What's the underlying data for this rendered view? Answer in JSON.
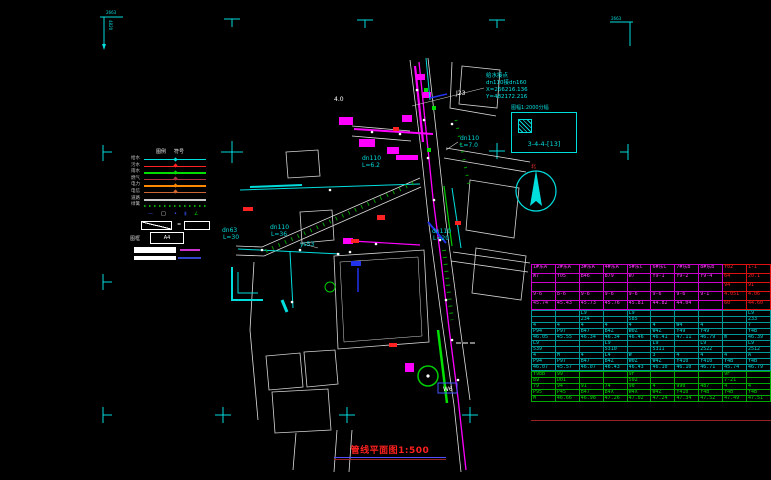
{
  "colors": {
    "accent_cyan": "#00dddd",
    "pipe_magenta": "#ff00ff",
    "road_white": "#e0e0e0",
    "veg_green": "#00cc00",
    "alert_red": "#ff2222",
    "aux_blue": "#2233ee"
  },
  "sheet": {
    "corner_tl_top": "2663",
    "corner_tl_side": "4820",
    "corner_tr": "2663"
  },
  "title": {
    "text": "管线平面图1:500"
  },
  "index_box": {
    "caption": "图幅1:2000分幅",
    "cell": "3-4-4-[13]"
  },
  "north": {
    "label": "北"
  },
  "note": {
    "lines": [
      "给水接点",
      "dn110接dn160",
      "X=266216.136",
      "Y=482172.216"
    ]
  },
  "map_labels": [
    {
      "text": "4.0",
      "x": 334,
      "y": 101,
      "color": "#ffffff"
    },
    {
      "text": "J23",
      "x": 456,
      "y": 95,
      "color": "#ffffff"
    },
    {
      "text": "dn110",
      "x": 460,
      "y": 140,
      "color": "#00dddd"
    },
    {
      "text": "L=7.0",
      "x": 460,
      "y": 147,
      "color": "#00dddd"
    },
    {
      "text": "dn110",
      "x": 362,
      "y": 160,
      "color": "#00dddd"
    },
    {
      "text": "L=6.2",
      "x": 362,
      "y": 167,
      "color": "#00dddd"
    },
    {
      "text": "dn110",
      "x": 270,
      "y": 229,
      "color": "#00dddd"
    },
    {
      "text": "L=36",
      "x": 271,
      "y": 236,
      "color": "#00dddd"
    },
    {
      "text": "dn110",
      "x": 432,
      "y": 233,
      "color": "#00dddd"
    },
    {
      "text": "L=20",
      "x": 433,
      "y": 240,
      "color": "#00dddd"
    },
    {
      "text": "dn63",
      "x": 222,
      "y": 232,
      "color": "#00dddd"
    },
    {
      "text": "L=30",
      "x": 223,
      "y": 239,
      "color": "#00dddd"
    },
    {
      "text": "ys53",
      "x": 300,
      "y": 246,
      "color": "#00dddd"
    },
    {
      "text": "W6",
      "x": 443,
      "y": 391,
      "color": "#ffffff"
    }
  ],
  "legend": {
    "headers": [
      "图例",
      "符号"
    ],
    "rows": [
      {
        "label": "给水",
        "color": "#00dddd",
        "sym": "#00dddd"
      },
      {
        "label": "污水",
        "color": "#ff2222",
        "sym": "#ff2222"
      },
      {
        "label": "雨水",
        "color": "#00dd00",
        "sym": "#00dd00"
      },
      {
        "label": "燃气",
        "color": "#aa3344",
        "sym": "#aa3344"
      },
      {
        "label": "电力",
        "color": "#ff8800",
        "sym": "#ff8800"
      },
      {
        "label": "电信",
        "color": "#cc6633",
        "sym": "#cc6633"
      },
      {
        "label": "道路",
        "color": "#c8c8c8",
        "h": "2.5px"
      },
      {
        "label": "绿篱",
        "style": "dotted"
      }
    ],
    "symbols": [
      {
        "g": "—",
        "c": "#4455ff",
        "x": "20px"
      },
      {
        "g": "□",
        "c": "#ffffff",
        "x": "33px"
      },
      {
        "g": "•",
        "c": "#4455ff",
        "x": "46px"
      },
      {
        "g": "▮",
        "c": "#223399",
        "x": "56px"
      },
      {
        "g": "∠",
        "c": "#00cc00",
        "x": "66px"
      }
    ],
    "slope_equals": "=",
    "frame_label": "图框",
    "frame_value": "A4"
  },
  "table": {
    "sections": [
      {
        "name": "existing-pipes",
        "rows": [
          [
            "1#东A",
            "2#东A",
            "3#东A",
            "4#东A",
            "5#东C",
            "6#东C",
            "7#东B",
            "8#东B",
            "Y02",
            "1-1"
          ],
          [
            "W7",
            "Y05",
            "B46",
            "B79",
            "W7",
            "Y9-1",
            "Y9-2",
            "Y9-4",
            "64",
            "20.1"
          ],
          [
            "",
            "",
            "",
            "",
            "",
            "",
            "",
            "",
            "94",
            "91"
          ],
          [
            "9-6",
            "8-6",
            "9-6",
            "9-6",
            "9-6",
            "9-6",
            "9-6",
            "9-1",
            "4.051",
            "4.06"
          ],
          [
            "45.74",
            "45.43",
            "45.73",
            "45.76",
            "45.81",
            "44.82",
            "44.04",
            "",
            "60",
            "44.60"
          ]
        ]
      },
      {
        "name": "design-pipes",
        "rows": [
          [
            "",
            "",
            "L9",
            "",
            "L9",
            "",
            "",
            "",
            "",
            "L9"
          ],
          [
            "",
            "",
            "234",
            "",
            "585",
            "",
            "",
            "",
            "",
            "233"
          ],
          [
            "4",
            "4",
            "4",
            "4",
            "4",
            "4",
            "W4",
            "4",
            "",
            "7"
          ],
          [
            "P94",
            "P97",
            "B47",
            "B4Z",
            "W0Z",
            "W4Z",
            "Y49",
            "Y49",
            "",
            "Y4B"
          ],
          [
            "46.05",
            "45.55",
            "46.34",
            "46.34",
            "46.46",
            "46.41",
            "47.11",
            "46.79",
            "m",
            "46.39"
          ],
          [
            "L9",
            "",
            "",
            "L9",
            "",
            "L9",
            "",
            "L9",
            "",
            "L9"
          ],
          [
            "539",
            "",
            "",
            "5310",
            "",
            "5311",
            "",
            "2522",
            "",
            "2512"
          ],
          [
            "4",
            "M",
            "4",
            "L4",
            "W",
            "3",
            "4",
            "4",
            "4",
            "A"
          ],
          [
            "P94",
            "P97",
            "B47",
            "B4Z",
            "W0Z",
            "W4Z",
            "Y410",
            "Y410",
            "Y4B",
            "Y4B"
          ],
          [
            "46.07",
            "45.57",
            "46.07",
            "46.43",
            "46.43",
            "46.10",
            "46.10",
            "46.71",
            "45.74",
            "46.79"
          ]
        ]
      },
      {
        "name": "ground-elevation",
        "rows": [
          [
            "Y98B",
            "99",
            "",
            "",
            "9F",
            "",
            "",
            "",
            "9F",
            ""
          ],
          [
            "89",
            "D01",
            "",
            "",
            "502",
            "",
            "",
            "",
            "7-21",
            ""
          ],
          [
            "79",
            "94",
            "91",
            "74",
            "90",
            "4",
            "990",
            "487",
            "4",
            "4"
          ],
          [
            "P95",
            "P45",
            "B47",
            "B4X",
            "W4X",
            "W4Z",
            "Y410",
            "Y4B",
            "Y4B",
            "Y4B"
          ],
          [
            "M",
            "46.66",
            "46.98",
            "47.26",
            "47.02",
            "47.24",
            "47.34",
            "47.52",
            "47.49",
            "47.51"
          ]
        ]
      }
    ]
  }
}
